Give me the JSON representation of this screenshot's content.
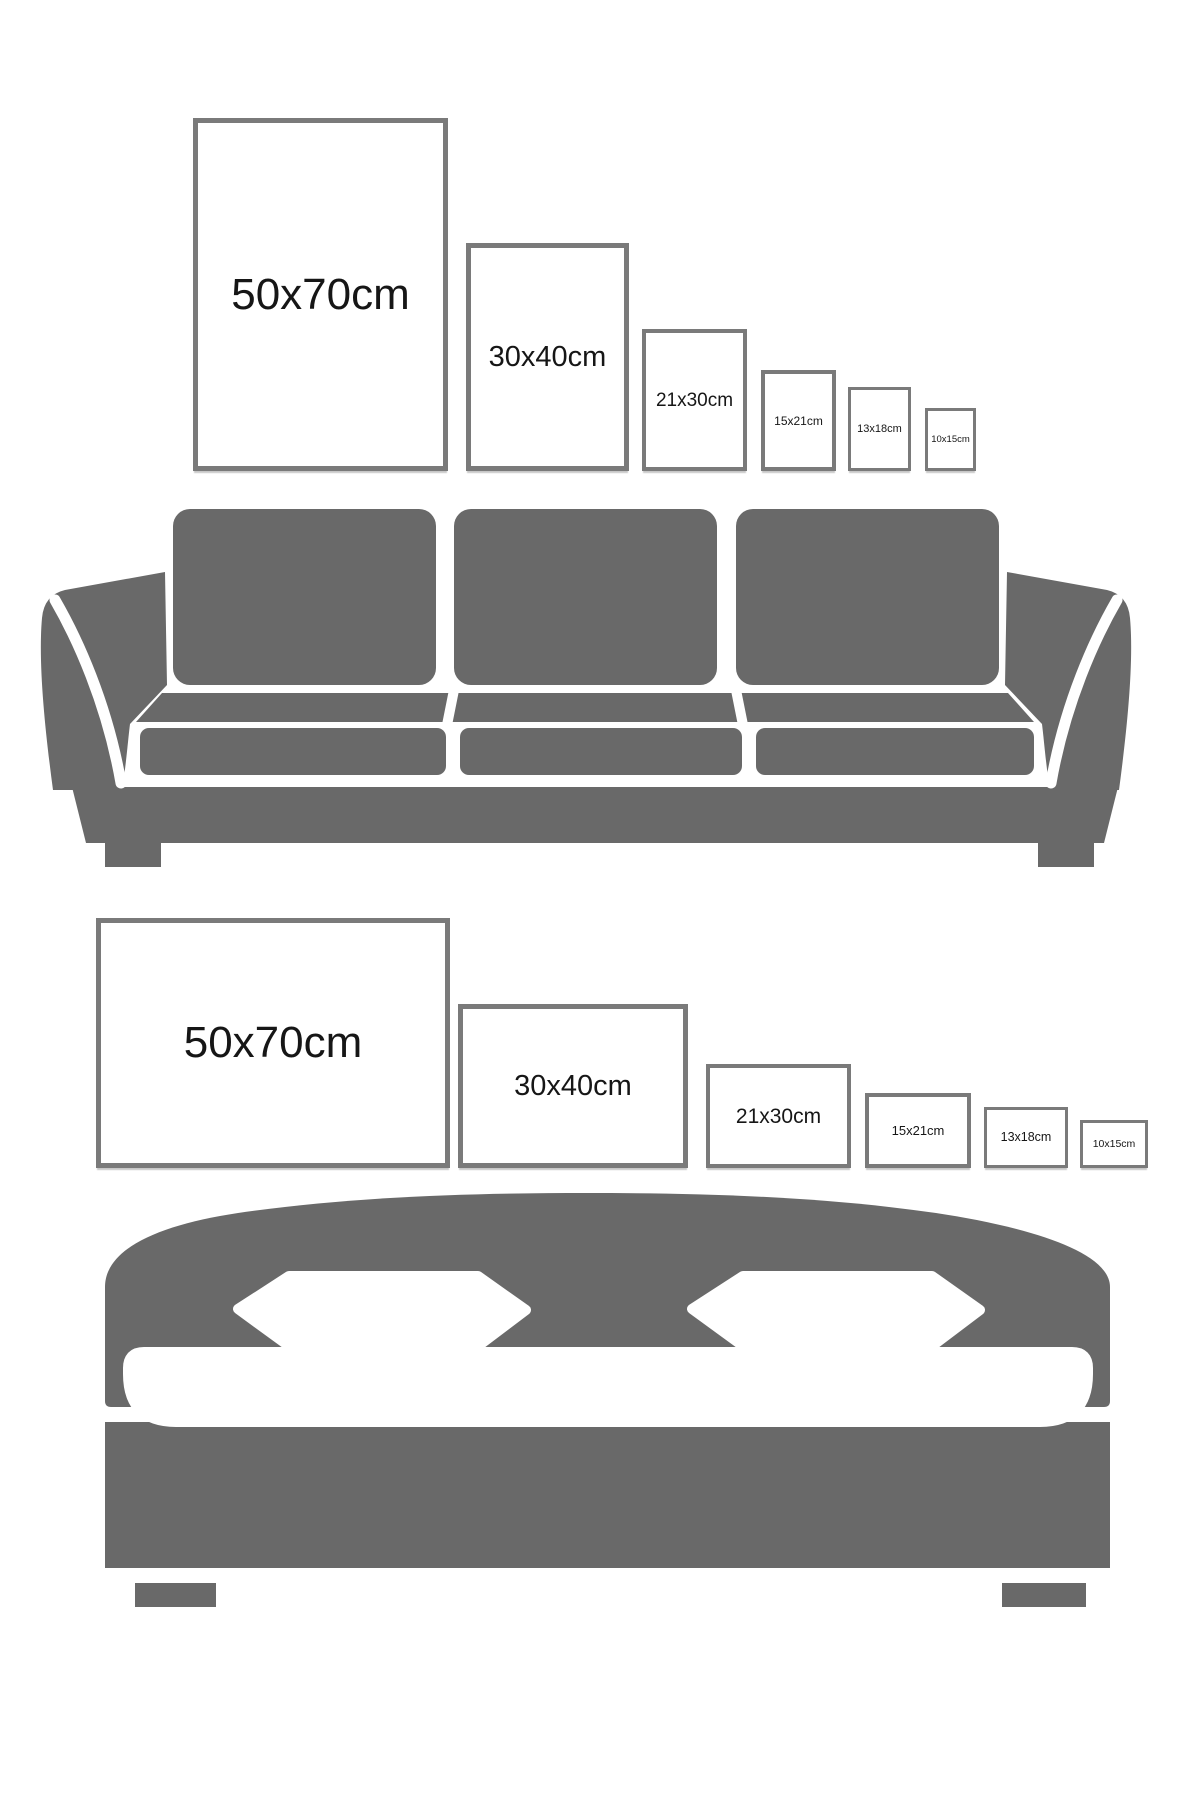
{
  "title": "poster size comparison guide",
  "colors": {
    "furniture_gray": "#696969",
    "frame_border_gray": "#7a7a7a",
    "label_text": "#161616",
    "background": "#ffffff"
  },
  "sofa_section": {
    "furniture_name": "sofa",
    "orientation": "portrait",
    "frames": [
      {
        "label": "50x70cm",
        "width_cm": 50,
        "height_cm": 70
      },
      {
        "label": "30x40cm",
        "width_cm": 30,
        "height_cm": 40
      },
      {
        "label": "21x30cm",
        "width_cm": 21,
        "height_cm": 30
      },
      {
        "label": "15x21cm",
        "width_cm": 15,
        "height_cm": 21
      },
      {
        "label": "13x18cm",
        "width_cm": 13,
        "height_cm": 18
      },
      {
        "label": "10x15cm",
        "width_cm": 10,
        "height_cm": 15
      }
    ]
  },
  "bed_section": {
    "furniture_name": "bed",
    "orientation": "landscape",
    "frames": [
      {
        "label": "50x70cm",
        "width_cm": 70,
        "height_cm": 50
      },
      {
        "label": "30x40cm",
        "width_cm": 40,
        "height_cm": 30
      },
      {
        "label": "21x30cm",
        "width_cm": 30,
        "height_cm": 21
      },
      {
        "label": "15x21cm",
        "width_cm": 21,
        "height_cm": 15
      },
      {
        "label": "13x18cm",
        "width_cm": 18,
        "height_cm": 13
      },
      {
        "label": "10x15cm",
        "width_cm": 15,
        "height_cm": 10
      }
    ]
  }
}
